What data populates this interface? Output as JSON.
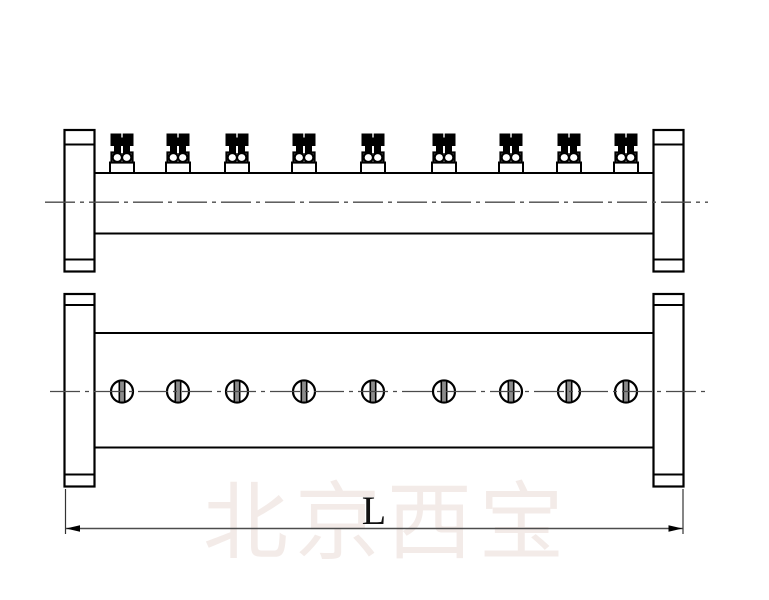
{
  "watermark": {
    "text": "北京西宝",
    "color": "#f3ebe8"
  },
  "dimension": {
    "label": "L"
  },
  "colors": {
    "outline": "#000000",
    "centerline": "#4a4a4a",
    "dimension_line": "#4d4d4d",
    "extension_line": "#333333",
    "slot_fill": "#8c8c8c",
    "fill_white": "#ffffff"
  },
  "top_view": {
    "valve_x_positions": [
      122,
      178,
      237,
      304,
      373,
      444,
      511,
      569,
      626
    ]
  },
  "front_view": {
    "hole_x_positions": [
      122,
      178,
      237,
      304,
      373,
      444,
      511,
      569,
      626
    ],
    "hole_radius": 11
  }
}
